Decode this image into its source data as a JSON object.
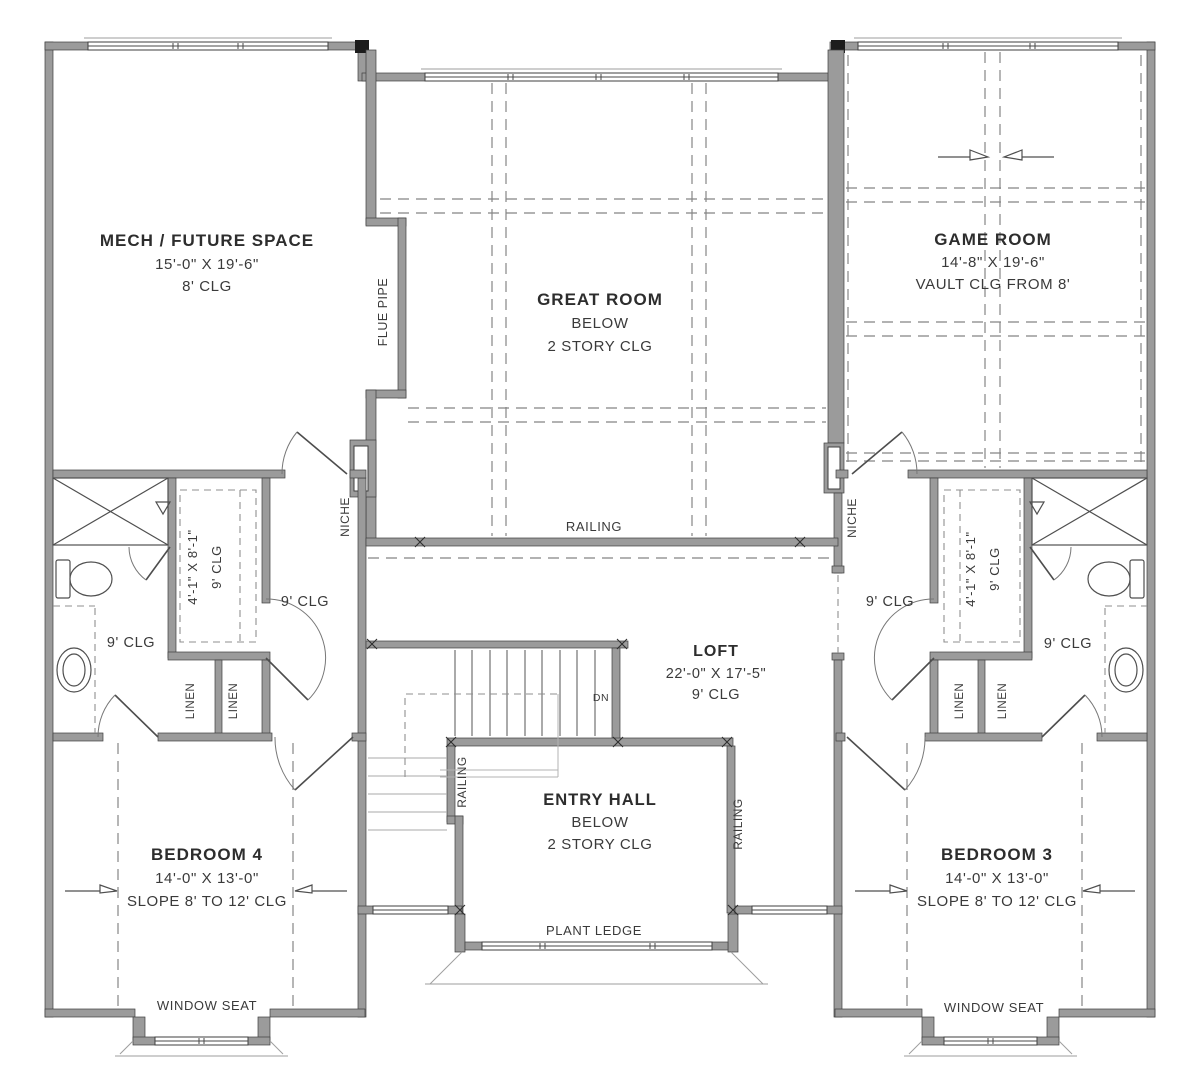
{
  "plan": {
    "title": "Second floor plan",
    "colors": {
      "wall": "#9b9b9b",
      "wall_edge": "#3f3f3f",
      "line": "#555555",
      "dash": "#858585",
      "text": "#2d2d2d",
      "background": "#ffffff"
    },
    "rooms": {
      "mech": {
        "name": "MECH / FUTURE SPACE",
        "dims": "15'-0\" X 19'-6\"",
        "ceiling": "8' CLG"
      },
      "great": {
        "name": "GREAT ROOM",
        "below": "BELOW",
        "ceiling": "2 STORY CLG"
      },
      "game": {
        "name": "GAME ROOM",
        "dims": "14'-8\" X 19'-6\"",
        "ceiling": "VAULT CLG FROM 8'"
      },
      "loft": {
        "name": "LOFT",
        "dims": "22'-0\" X 17'-5\"",
        "ceiling": "9' CLG"
      },
      "entry": {
        "name": "ENTRY HALL",
        "below": "BELOW",
        "ceiling": "2 STORY CLG"
      },
      "bed4": {
        "name": "BEDROOM 4",
        "dims": "14'-0\" X 13'-0\"",
        "ceiling": "SLOPE 8' TO 12' CLG"
      },
      "bed3": {
        "name": "BEDROOM 3",
        "dims": "14'-0\" X 13'-0\"",
        "ceiling": "SLOPE 8' TO 12' CLG"
      },
      "closet": {
        "dims": "4'-1\" X 8'-1\"",
        "ceiling": "9' CLG"
      }
    },
    "labels": {
      "flue_pipe": "FLUE PIPE",
      "railing": "RAILING",
      "niche": "NICHE",
      "linen": "LINEN",
      "dn": "DN",
      "plant_ledge": "PLANT LEDGE",
      "window_seat": "WINDOW SEAT",
      "clg9": "9' CLG"
    }
  }
}
